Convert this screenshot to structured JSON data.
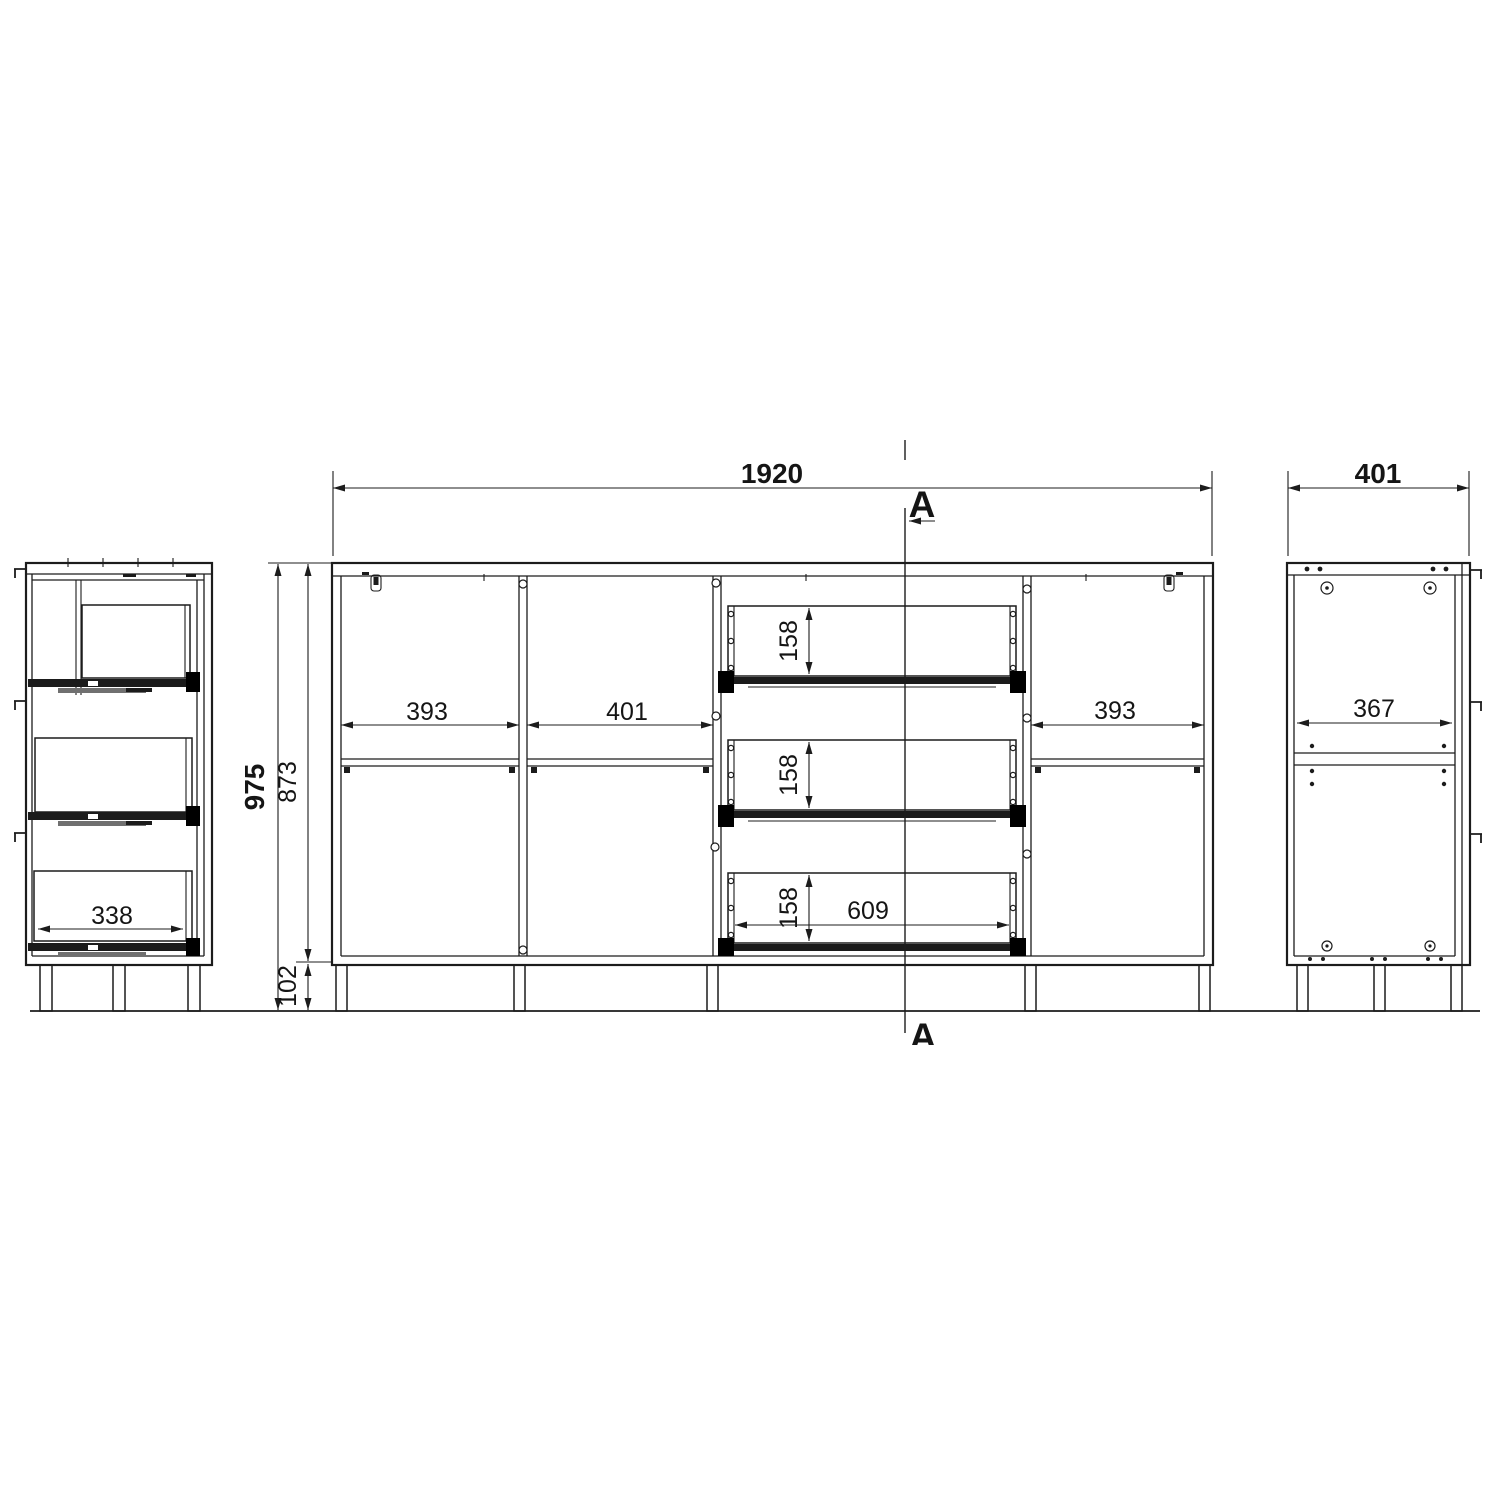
{
  "section_marks": {
    "top": "A",
    "bottom": "A"
  },
  "dimensions": {
    "front": {
      "overall_width": "1920",
      "overall_height": "975",
      "carcass_height": "873",
      "leg_height": "102",
      "left_door_bay_width": "393",
      "open_bay_width": "401",
      "right_door_bay_width": "393",
      "drawer_heights": [
        "158",
        "158",
        "158"
      ],
      "drawer_opening_width": "609"
    },
    "side_view": {
      "overall_depth": "401",
      "interior_depth": "367"
    },
    "section_view": {
      "drawer_depth": "338"
    }
  },
  "colors": {
    "line": "#1c1c1c",
    "background": "#ffffff",
    "rail_fill": "#1b1b1b"
  }
}
